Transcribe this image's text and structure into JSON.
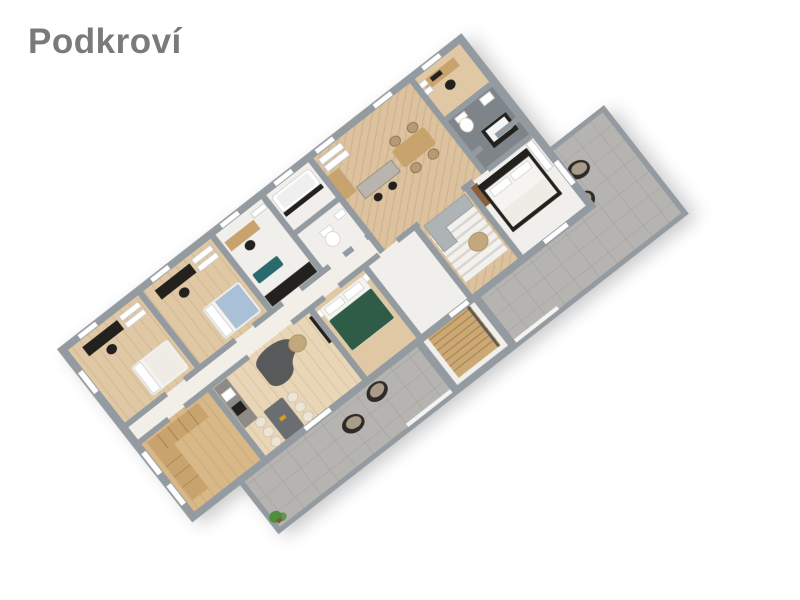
{
  "page": {
    "title": "Podkroví",
    "background": "#ffffff"
  },
  "palette": {
    "page_bg": "#ffffff",
    "title": "#7a7a7a",
    "wall": "#939aa0",
    "floor_white": "#f0efec",
    "floor_wood": "#dfc8a3",
    "floor_wood_light": "#e8d6b6",
    "floor_herringbone": "#dcc29e",
    "floor_closet": "#d8b887",
    "floor_tile_dark": "#7e858a",
    "corridor": "#f2efe9",
    "terrace": "#b5b4b1",
    "furn_black": "#23211e",
    "furn_wood": "#c9a36e",
    "furn_wood_dark": "#8a5f3a",
    "sofa_dark": "#57595a",
    "sofa_light": "#aeb3b6",
    "bed_green": "#2f5c47",
    "bed_blue": "#a9c0d6",
    "chair_cream": "#ece4d4",
    "table_gray": "#6b6e70",
    "rug_teal": "#2a6a6e",
    "ottoman": "#c3a87e",
    "plant": "#4d8f3a",
    "island_top": "#b9b5ae",
    "counter_gray": "#8e8b86",
    "mattress": "#f6f4f0",
    "linen": "#efece6"
  },
  "floorplan": {
    "floor_label": "Podkroví",
    "view": "3d-top-down-rotated",
    "rooms": [
      {
        "name": "kids-bedroom-1",
        "furniture": [
          "desk",
          "office-chair",
          "wall-shelves",
          "single-bed"
        ]
      },
      {
        "name": "kids-bedroom-2",
        "furniture": [
          "desk",
          "office-chair",
          "wall-shelves",
          "single-bed-blue"
        ]
      },
      {
        "name": "study",
        "furniture": [
          "desk",
          "office-chair",
          "black-counter",
          "teal-rug"
        ]
      },
      {
        "name": "bathroom-small",
        "furniture": [
          "bathtub"
        ]
      },
      {
        "name": "wc",
        "furniture": [
          "toilet",
          "washbasin"
        ]
      },
      {
        "name": "kitchen-dining",
        "furniture": [
          "wall-shelves",
          "tall-cabinet",
          "kitchen-island",
          "bar-stools",
          "dining-table",
          "dining-chairs"
        ]
      },
      {
        "name": "office",
        "furniture": [
          "desk",
          "monitor",
          "office-chair",
          "shelving"
        ]
      },
      {
        "name": "bathroom-main",
        "furniture": [
          "toilet",
          "black-bathtub"
        ]
      },
      {
        "name": "walk-in-closet",
        "furniture": [
          "wardrobes"
        ]
      },
      {
        "name": "living-room",
        "furniture": [
          "kitchenette-counter",
          "curved-sofa",
          "round-side-table",
          "tv-panel",
          "dining-table",
          "cream-chairs"
        ]
      },
      {
        "name": "bedroom-green",
        "furniture": [
          "double-bed-green",
          "nightstands"
        ]
      },
      {
        "name": "stair-hall",
        "furniture": [
          "wooden-staircase"
        ]
      },
      {
        "name": "lounge-area",
        "furniture": [
          "corner-sofa",
          "striped-rug",
          "round-ottoman"
        ]
      },
      {
        "name": "bedroom-master",
        "furniture": [
          "double-bed",
          "wardrobe",
          "closet-shelf"
        ]
      },
      {
        "name": "terrace",
        "furniture": [
          "lounge-chair",
          "lounge-chair",
          "lounge-chair",
          "lounge-chair",
          "potted-plant"
        ]
      }
    ]
  }
}
